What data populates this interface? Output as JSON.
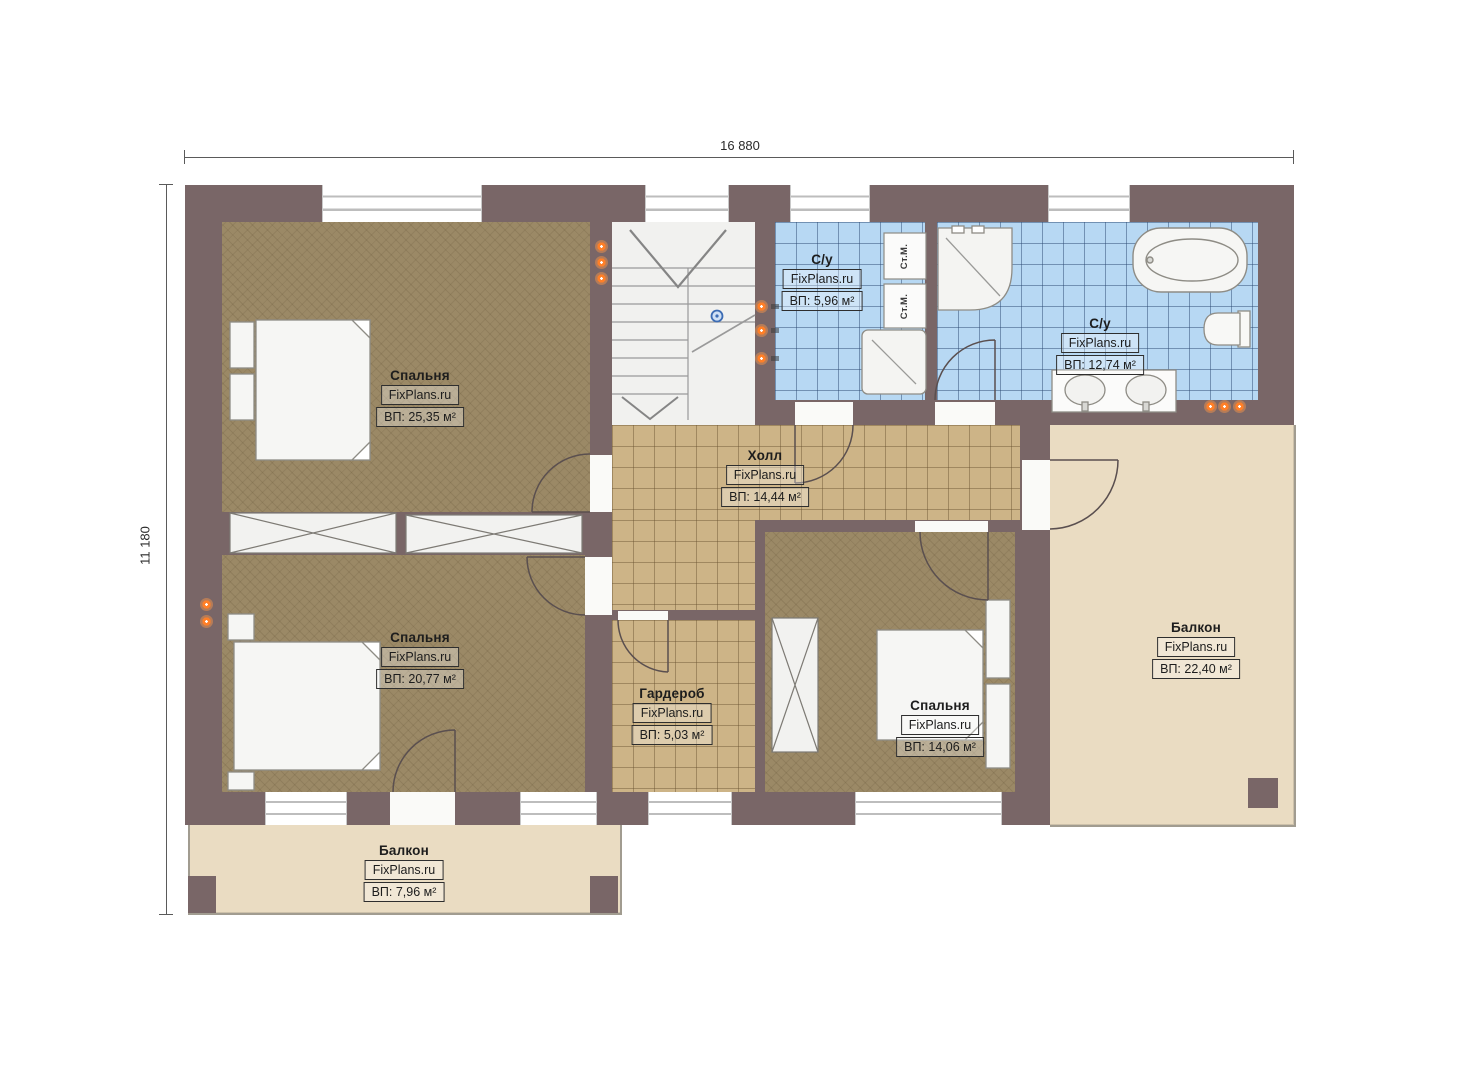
{
  "plan": {
    "dimensions": {
      "width_label": "16 880",
      "height_label": "11 180"
    },
    "watermark": "FixPlans.ru",
    "rooms": [
      {
        "name": "Спальня",
        "area": "ВП: 25,35 м²"
      },
      {
        "name": "С/у",
        "area": "ВП: 5,96 м²"
      },
      {
        "name": "С/у",
        "area": "ВП: 12,74 м²"
      },
      {
        "name": "Холл",
        "area": "ВП: 14,44 м²"
      },
      {
        "name": "Спальня",
        "area": "ВП: 20,77 м²"
      },
      {
        "name": "Гардероб",
        "area": "ВП: 5,03 м²"
      },
      {
        "name": "Спальня",
        "area": "ВП: 14,06 м²"
      },
      {
        "name": "Балкон",
        "area": "ВП: 22,40 м²"
      },
      {
        "name": "Балкон",
        "area": "ВП: 7,96 м²"
      }
    ],
    "appliance_labels": {
      "washing_machine": "Ст.М."
    },
    "colors": {
      "wall": "#796667",
      "bedroom_floor": "#9b8966",
      "tile_floor": "#cdb487",
      "bath_floor": "#b7d8f3",
      "balcony_floor": "#eadcc2",
      "outlet": "#ff7f27",
      "stair_marker": "#3c6cb4"
    }
  }
}
